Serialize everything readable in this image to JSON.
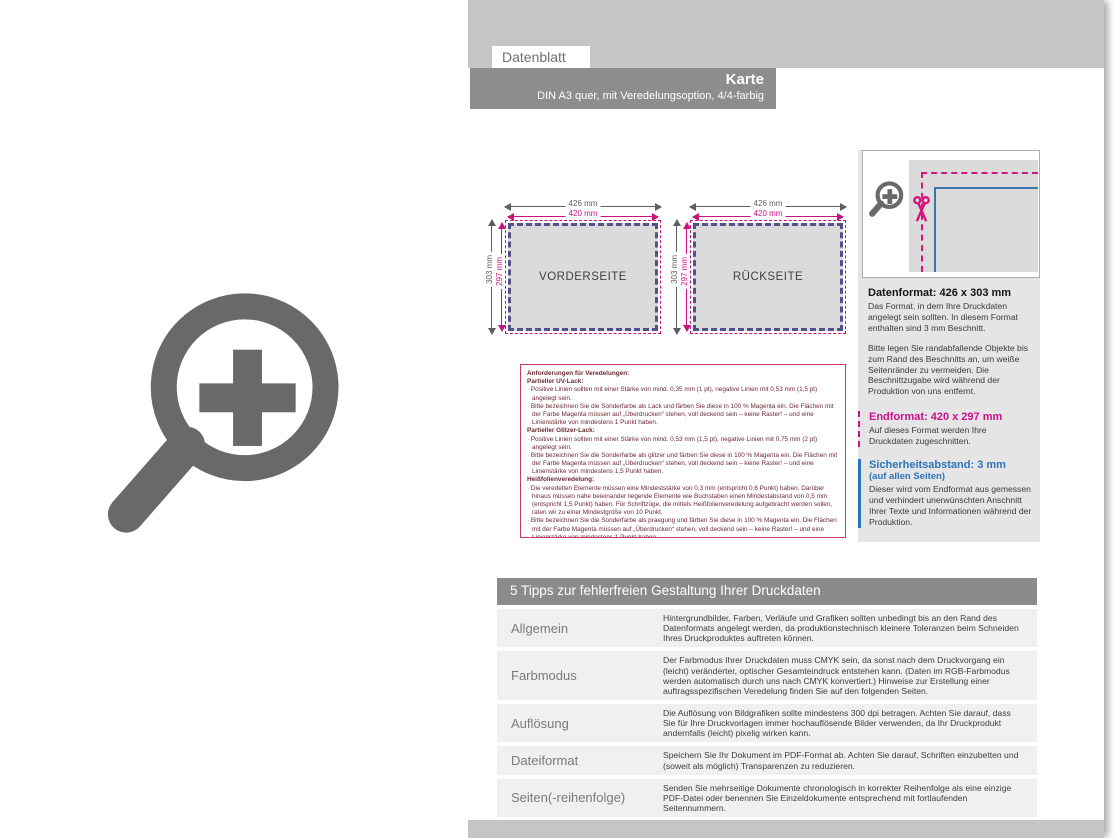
{
  "header": {
    "tab": "Datenblatt",
    "title": "Karte",
    "subtitle": "DIN A3 quer, mit Veredelungsoption, 4/4-farbig"
  },
  "diagrams": {
    "front": {
      "label": "VORDERSEITE",
      "width_outer": "426 mm",
      "width_inner": "420 mm",
      "height_outer": "303 mm",
      "height_inner": "297 mm"
    },
    "back": {
      "label": "RÜCKSEITE",
      "width_outer": "426 mm",
      "width_inner": "420 mm",
      "height_outer": "303 mm",
      "height_inner": "297 mm"
    }
  },
  "requirements_box": {
    "lines": [
      {
        "style": "head",
        "text": "Anforderungen für Veredelungen:"
      },
      {
        "style": "head",
        "text": "Partieller UV-Lack:"
      },
      {
        "style": "bullet",
        "text": "· Positive Linien sollten mit einer Stärke von mind. 0,35 mm (1 pt), negative Linien mit 0,53 mm (1,5 pt) angelegt sein."
      },
      {
        "style": "bullet",
        "text": "· Bitte bezeichnen Sie die Sonderfarbe als Lack und färben Sie diese in 100 % Magenta ein. Die Flächen mit der Farbe Magenta müssen auf „Überdrucken“ stehen, voll deckend sein – keine Raster! – und eine Linienstärke von mindestens 1 Punkt haben."
      },
      {
        "style": "head",
        "text": "Partieller Glitzer-Lack:"
      },
      {
        "style": "bullet",
        "text": "· Positive Linien sollten mit einer Stärke von mind. 0,53 mm (1,5 pt), negative Linien mit 0,75 mm (2 pt) angelegt sein."
      },
      {
        "style": "bullet",
        "text": "· Bitte bezeichnen Sie die Sonderfarbe als glitzer und färben Sie diese in 100 % Magenta ein. Die Flächen mit der Farbe Magenta müssen auf „Überdrucken“ stehen, voll deckend sein – keine Raster! – und eine Linienstärke von mindestens 1,5 Punkt haben."
      },
      {
        "style": "head",
        "text": "Heißfolienveredelung:"
      },
      {
        "style": "bullet",
        "text": "· Die veredelten Elemente müssen eine Mindeststärke von 0,3 mm (entspricht 0,6 Punkt) haben. Darüber hinaus müssen nahe beieinander liegende Elemente wie Buchstaben einen Mindestabstand von 0,5 mm (entspricht 1,5 Punkt) haben. Für Schriftzüge, die mittels Heißfolienveredelung aufgebracht werden sollen, raten wir zu einer Mindestgröße von 10 Punkt."
      },
      {
        "style": "bullet",
        "text": "· Bitte bezeichnen Sie die Sonderfarbe als praegung und färben Sie diese in 100 % Magenta ein. Die Flächen mit der Farbe Magenta müssen auf „Überdrucken“ stehen, voll deckend sein – keine Raster! – und eine Linienstärke von mindestens 1 Punkt haben."
      }
    ]
  },
  "info_panel": {
    "datenformat": {
      "heading": "Datenformat: 426 x 303 mm",
      "p1": "Das Format, in dem Ihre Druckdaten angelegt sein sollten. In diesem Format enthalten sind 3 mm Beschnitt.",
      "p2": "Bitte legen Sie randabfallende Objekte bis zum Rand des Beschnitts an, um weiße Seitenränder zu vermeiden. Die Beschnittzugabe wird während der Produktion von uns entfernt."
    },
    "endformat": {
      "heading": "Endformat: 420 x 297 mm",
      "body": "Auf dieses Format werden Ihre Druckdaten zugeschnitten."
    },
    "sicherheitsabstand": {
      "heading": "Sicherheitsabstand: 3 mm",
      "subheading": "(auf allen Seiten)",
      "body": "Dieser wird vom Endformat aus gemessen und verhindert unerwünschten Anschnitt Ihrer Texte und Informationen während der Produktion."
    }
  },
  "tips_table": {
    "title": "5 Tipps zur fehlerfreien Gestaltung Ihrer Druckdaten",
    "rows": [
      {
        "label": "Allgemein",
        "text": "Hintergrundbilder, Farben, Verläufe und Grafiken sollten unbedingt bis an den Rand des Datenformats angelegt werden, da produktionstechnisch kleinere Toleranzen beim Schneiden Ihres Druckproduktes auftreten können."
      },
      {
        "label": "Farbmodus",
        "text": "Der Farbmodus Ihrer Druckdaten muss CMYK sein, da sonst nach dem Druckvorgang ein (leicht) veränderter, optischer Gesamteindruck entstehen kann. (Daten im RGB-Farbmodus werden automatisch durch uns nach CMYK konvertiert.) Hinweise zur Erstellung einer auftragsspezifischen Veredelung finden Sie auf den folgenden Seiten."
      },
      {
        "label": "Auflösung",
        "text": "Die Auflösung von Bildgrafiken sollte mindestens 300 dpi betragen. Achten Sie darauf, dass Sie für Ihre Druckvorlagen immer hochauflösende Bilder verwenden, da Ihr Druckprodukt andernfalls (leicht) pixelig wirken kann."
      },
      {
        "label": "Dateiformat",
        "text": "Speichern Sie Ihr Dokument im PDF-Format ab. Achten Sie darauf, Schriften einzubetten und (soweit als möglich) Transparenzen zu reduzieren."
      },
      {
        "label": "Seiten(-reihenfolge)",
        "text": "Senden Sie mehrseitige Dokumente chronologisch in korrekter Reihenfolge als eine einzige PDF-Datei oder benennen Sie Einzeldokumente entsprechend mit fortlaufenden Seitennummern."
      }
    ]
  },
  "icons": {
    "big_magnifier": "zoom-plus-magnifier",
    "thumb_magnifier": "zoom-plus-magnifier",
    "scissors": "scissors-cut-line"
  },
  "colors": {
    "band_gray": "#c6c5c5",
    "bar_gray": "#8e8d8d",
    "magenta": "#c9117f",
    "blue": "#2d74b7",
    "navy_dash": "#52528b",
    "light_blue_dash": "#a9cde9",
    "red_box_border": "#c73a5e",
    "red_box_text": "#6b2b35",
    "row_bg": "#f1f0ef",
    "icon_gray": "#696969"
  }
}
